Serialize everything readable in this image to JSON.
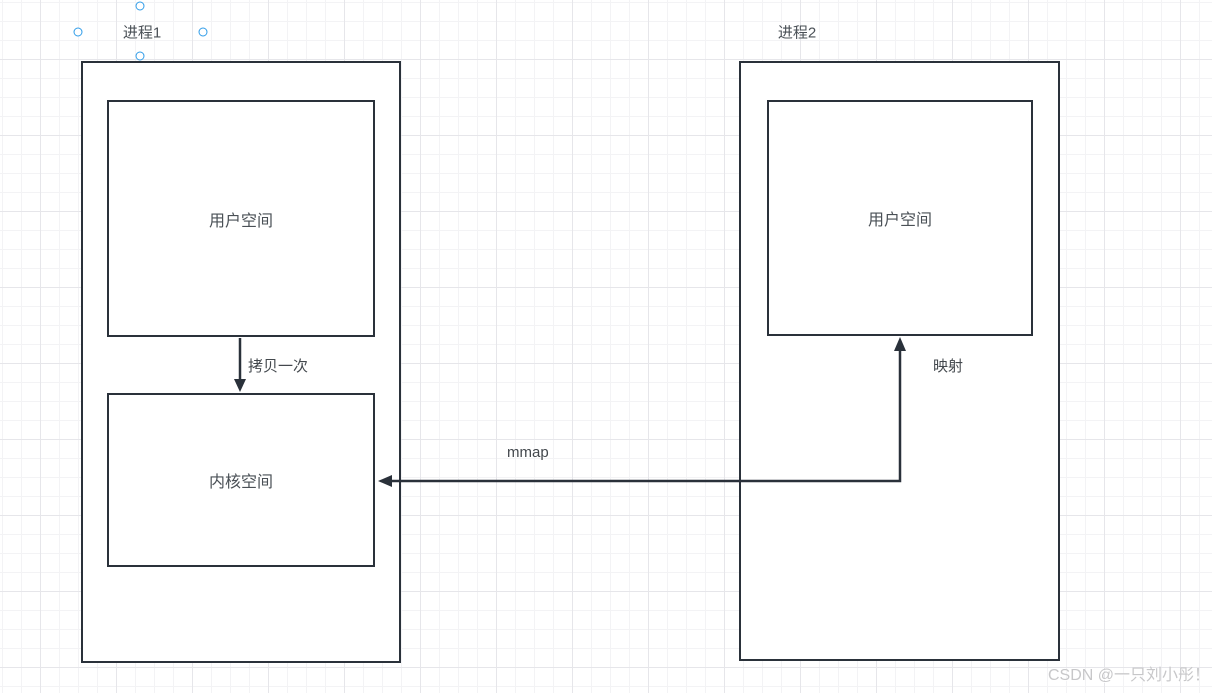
{
  "diagram": {
    "process1": {
      "title": "进程1",
      "user_space_label": "用户空间",
      "kernel_space_label": "内核空间"
    },
    "process2": {
      "title": "进程2",
      "user_space_label": "用户空间"
    },
    "edges": {
      "copy_label": "拷贝一次",
      "mmap_label": "mmap",
      "map_label": "映射"
    },
    "colors": {
      "stroke": "#2a313a",
      "text": "#4a5056",
      "selection_handle": "#2f9ce8",
      "grid_minor": "#f3f3f5",
      "grid_major": "#e6e6ea",
      "watermark": "#c7c7c9"
    }
  },
  "watermark": "CSDN @一只刘小彤！"
}
